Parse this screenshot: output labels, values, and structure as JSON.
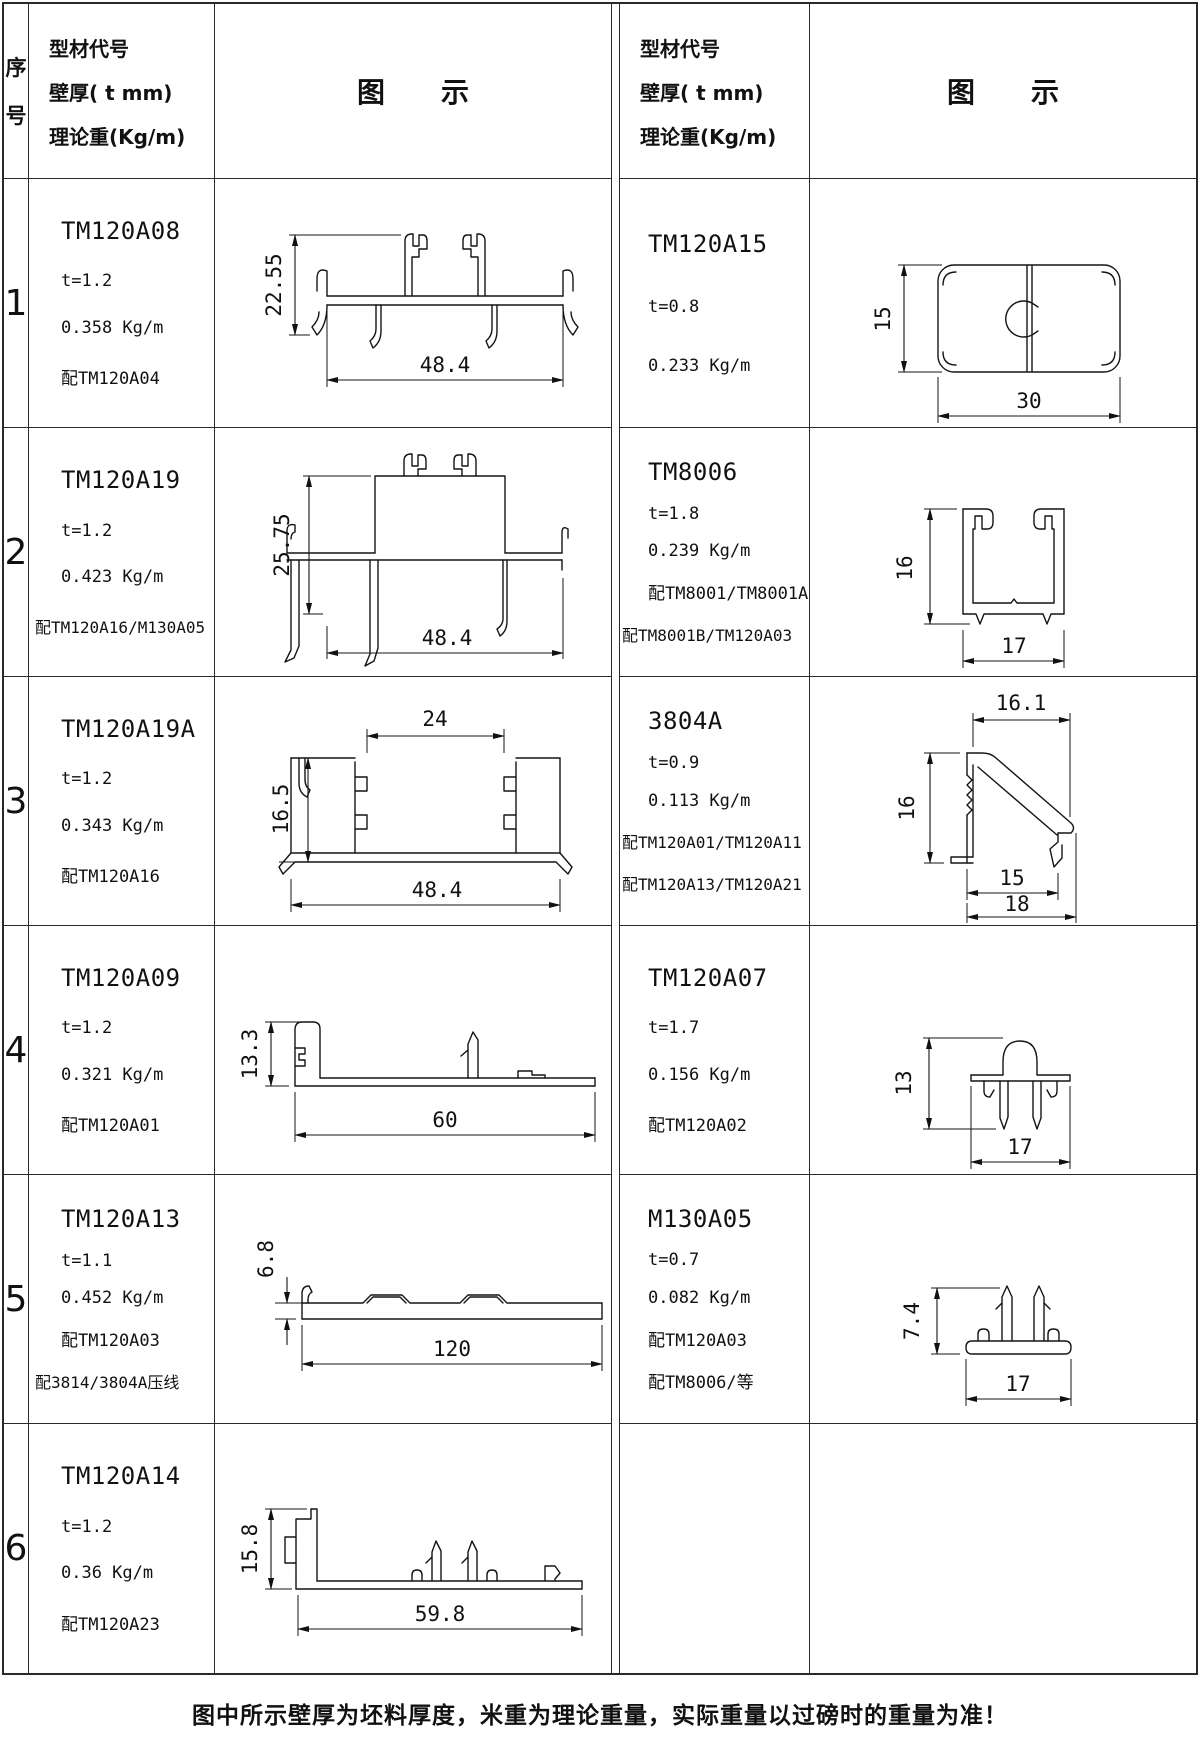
{
  "header": {
    "seq_top": "序",
    "seq_bottom": "号",
    "spec_lines": [
      "型材代号",
      "壁厚( t mm)",
      "理论重(Kg/m)"
    ],
    "diagram_label": "图　　示"
  },
  "footer_note": "图中所示壁厚为坯料厚度，米重为理论重量，实际重量以过磅时的重量为准！",
  "rows": [
    {
      "seq": "1",
      "left": {
        "code": "TM120A08",
        "lines": [
          "t=1.2",
          "0.358 Kg/m",
          "配TM120A04"
        ],
        "dims": {
          "h": "22.55",
          "w": "48.4"
        }
      },
      "right": {
        "code": "TM120A15",
        "lines": [
          "t=0.8",
          "0.233 Kg/m"
        ],
        "dims": {
          "h": "15",
          "w": "30"
        }
      }
    },
    {
      "seq": "2",
      "left": {
        "code": "TM120A19",
        "lines": [
          "t=1.2",
          "0.423 Kg/m",
          "配TM120A16/M130A05"
        ],
        "dims": {
          "h": "25.75",
          "w": "48.4"
        }
      },
      "right": {
        "code": "TM8006",
        "lines": [
          "t=1.8",
          "0.239 Kg/m",
          "配TM8001/TM8001A",
          "配TM8001B/TM120A03"
        ],
        "dims": {
          "h": "16",
          "w": "17"
        }
      }
    },
    {
      "seq": "3",
      "left": {
        "code": "TM120A19A",
        "lines": [
          "t=1.2",
          "0.343 Kg/m",
          "配TM120A16"
        ],
        "dims": {
          "top": "24",
          "h": "16.5",
          "w": "48.4"
        }
      },
      "right": {
        "code": "3804A",
        "lines": [
          "t=0.9",
          "0.113 Kg/m",
          "配TM120A01/TM120A11",
          "配TM120A13/TM120A21"
        ],
        "dims": {
          "top": "16.1",
          "h": "16",
          "w1": "15",
          "w2": "18"
        }
      }
    },
    {
      "seq": "4",
      "left": {
        "code": "TM120A09",
        "lines": [
          "t=1.2",
          "0.321 Kg/m",
          "配TM120A01"
        ],
        "dims": {
          "h": "13.3",
          "w": "60"
        }
      },
      "right": {
        "code": "TM120A07",
        "lines": [
          "t=1.7",
          "0.156 Kg/m",
          "配TM120A02"
        ],
        "dims": {
          "h": "13",
          "w": "17"
        }
      }
    },
    {
      "seq": "5",
      "left": {
        "code": "TM120A13",
        "lines": [
          "t=1.1",
          "0.452 Kg/m",
          "配TM120A03",
          "配3814/3804A压线"
        ],
        "dims": {
          "h": "6.8",
          "w": "120"
        }
      },
      "right": {
        "code": "M130A05",
        "lines": [
          "t=0.7",
          "0.082 Kg/m",
          "配TM120A03",
          "配TM8006/等"
        ],
        "dims": {
          "h": "7.4",
          "w": "17"
        }
      }
    },
    {
      "seq": "6",
      "left": {
        "code": "TM120A14",
        "lines": [
          "t=1.2",
          "0.36 Kg/m",
          "配TM120A23"
        ],
        "dims": {
          "h": "15.8",
          "w": "59.8"
        }
      },
      "right": null
    }
  ]
}
